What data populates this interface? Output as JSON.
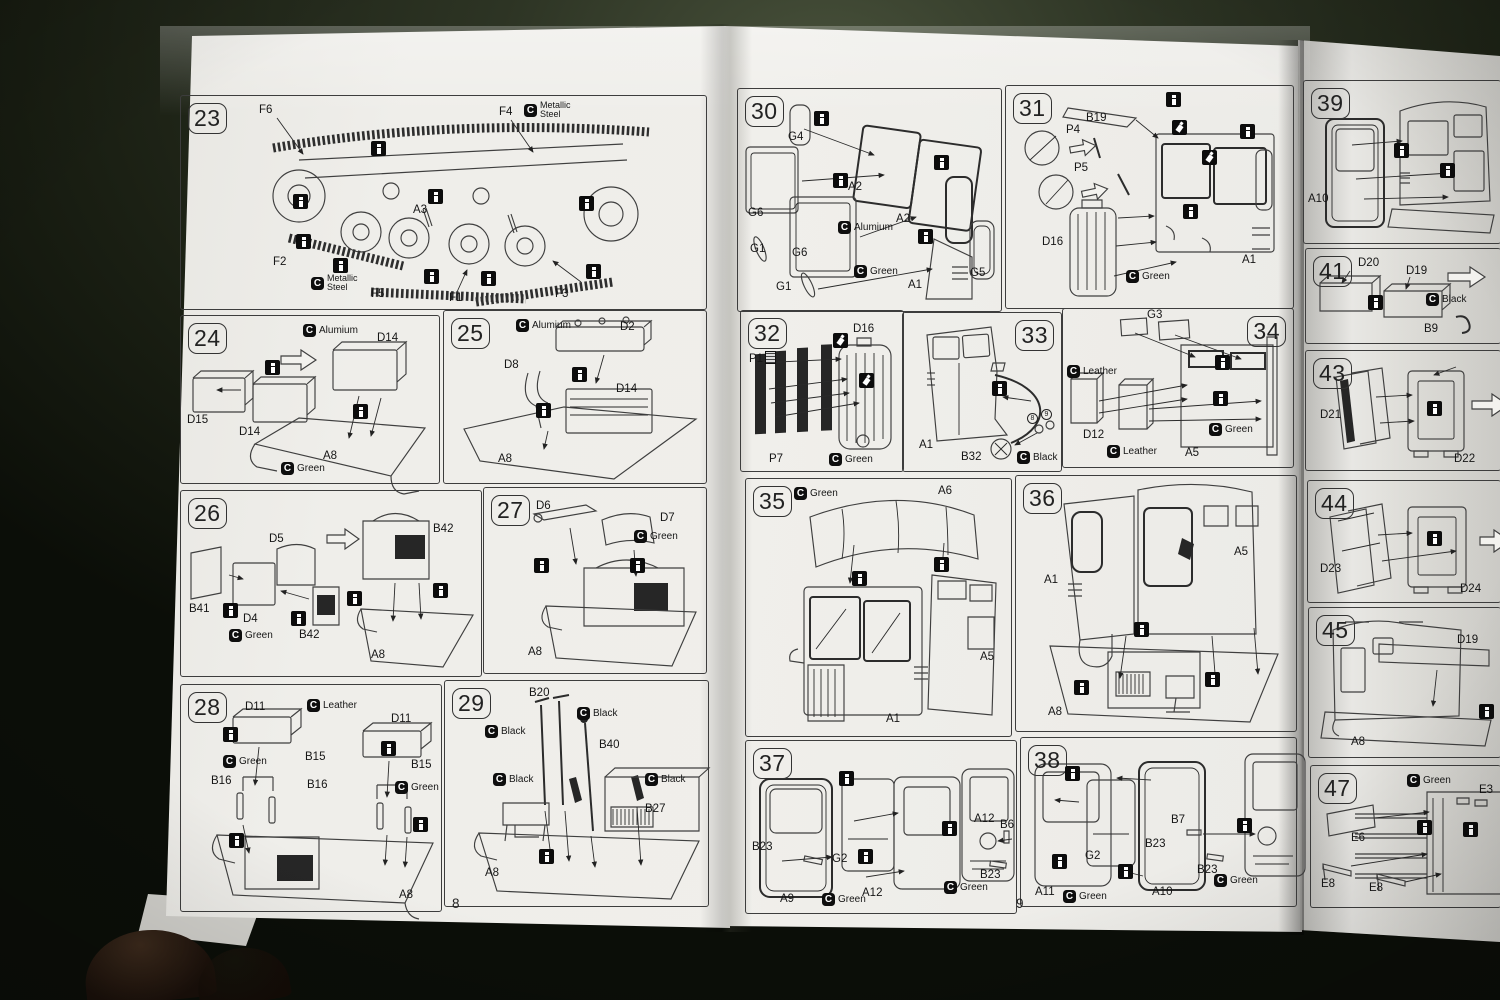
{
  "document": {
    "type": "model-kit-assembly-instructions",
    "paper_color": "#efeeea",
    "backdrop_color": "#2d3424",
    "ink_color": "#1d1d1d"
  },
  "icons": {
    "color_chip_glyph": "C",
    "glue_symbol": "i"
  },
  "pages": {
    "left": {
      "number": "8"
    },
    "right": {
      "number": "9"
    }
  },
  "steps": {
    "s23": {
      "num": "23",
      "chip_top": "Metallic Steel",
      "chip_bottom": "Metallic Steel",
      "parts": {
        "f6": "F6",
        "f4": "F4",
        "a3": "A3",
        "f2": "F2",
        "f5": "F5",
        "f1": "F1",
        "f3": "F3"
      }
    },
    "s24": {
      "num": "24",
      "chips": {
        "alumium": "Alumium",
        "green": "Green"
      },
      "parts": {
        "d14a": "D14",
        "d15": "D15",
        "d14b": "D14",
        "a8": "A8"
      }
    },
    "s25": {
      "num": "25",
      "chips": {
        "alumium": "Alumium"
      },
      "parts": {
        "d2": "D2",
        "d8": "D8",
        "d14": "D14",
        "a8": "A8"
      }
    },
    "s26": {
      "num": "26",
      "chips": {
        "green": "Green"
      },
      "parts": {
        "b42a": "B42",
        "d5": "D5",
        "b41": "B41",
        "d4": "D4",
        "b42b": "B42",
        "a8": "A8"
      }
    },
    "s27": {
      "num": "27",
      "chips": {
        "green": "Green"
      },
      "parts": {
        "d6": "D6",
        "d7": "D7",
        "a8": "A8"
      }
    },
    "s28": {
      "num": "28",
      "chips": {
        "leather": "Leather",
        "green_a": "Green",
        "green_b": "Green"
      },
      "parts": {
        "d11a": "D11",
        "d11b": "D11",
        "b15a": "B15",
        "b15b": "B15",
        "b16a": "B16",
        "b16b": "B16",
        "a8": "A8"
      }
    },
    "s29": {
      "num": "29",
      "chips": {
        "black_a": "Black",
        "black_b": "Black",
        "black_c": "Black",
        "black_d": "Black"
      },
      "parts": {
        "b20": "B20",
        "b40": "B40",
        "b27": "B27",
        "a8": "A8"
      }
    },
    "s30": {
      "num": "30",
      "chips": {
        "alumium": "Alumium",
        "green": "Green"
      },
      "parts": {
        "g4": "G4",
        "g6a": "G6",
        "a2a": "A2",
        "g1a": "G1",
        "g6b": "G6",
        "a2b": "A2",
        "g1b": "G1",
        "a1": "A1",
        "g5": "G5"
      }
    },
    "s31": {
      "num": "31",
      "chips": {
        "green": "Green"
      },
      "parts": {
        "b19": "B19",
        "p4": "P4",
        "p5": "P5",
        "d16": "D16",
        "a1": "A1"
      }
    },
    "s32": {
      "num": "32",
      "chips": {
        "green": "Green"
      },
      "parts": {
        "d16": "D16",
        "p1": "P1",
        "p7": "P7"
      }
    },
    "s33": {
      "num": "33",
      "chips": {
        "black": "Black"
      },
      "parts": {
        "a1": "A1",
        "b32": "B32"
      },
      "circled_a": "8",
      "circled_b": "9"
    },
    "s34": {
      "num": "34",
      "chips": {
        "leather_a": "Leather",
        "leather_b": "Leather",
        "green": "Green"
      },
      "parts": {
        "g3": "G3",
        "d12": "D12",
        "a5": "A5"
      }
    },
    "s35": {
      "num": "35",
      "chips": {
        "green": "Green"
      },
      "parts": {
        "a6": "A6",
        "a5": "A5",
        "a1": "A1"
      }
    },
    "s36": {
      "num": "36",
      "parts": {
        "a5": "A5",
        "a1": "A1",
        "a8": "A8"
      }
    },
    "s37": {
      "num": "37",
      "chips": {
        "green_a": "Green",
        "green_b": "Green"
      },
      "parts": {
        "b23a": "B23",
        "g2": "G2",
        "a9": "A9",
        "a12a": "A12",
        "a12b": "A12",
        "b6": "B6",
        "b23b": "B23"
      }
    },
    "s38": {
      "num": "38",
      "chips": {
        "green_a": "Green",
        "green_b": "Green"
      },
      "parts": {
        "g2": "G2",
        "b23a": "B23",
        "a11": "A11",
        "a10": "A10",
        "b7": "B7",
        "b23b": "B23"
      }
    },
    "s39": {
      "num": "39",
      "parts": {
        "a10": "A10"
      }
    },
    "s41": {
      "num": "41",
      "chips": {
        "black": "Black"
      },
      "parts": {
        "d20": "D20",
        "d19": "D19",
        "b9": "B9"
      }
    },
    "s43": {
      "num": "43",
      "parts": {
        "d21": "D21",
        "d22": "D22"
      }
    },
    "s44": {
      "num": "44",
      "parts": {
        "d23": "D23",
        "d24": "D24"
      }
    },
    "s45": {
      "num": "45",
      "parts": {
        "d19": "D19",
        "a8": "A8"
      }
    },
    "s47": {
      "num": "47",
      "chips": {
        "green": "Green"
      },
      "parts": {
        "e3": "E3",
        "e6": "E6",
        "e8a": "E8",
        "e8b": "E8"
      }
    }
  }
}
